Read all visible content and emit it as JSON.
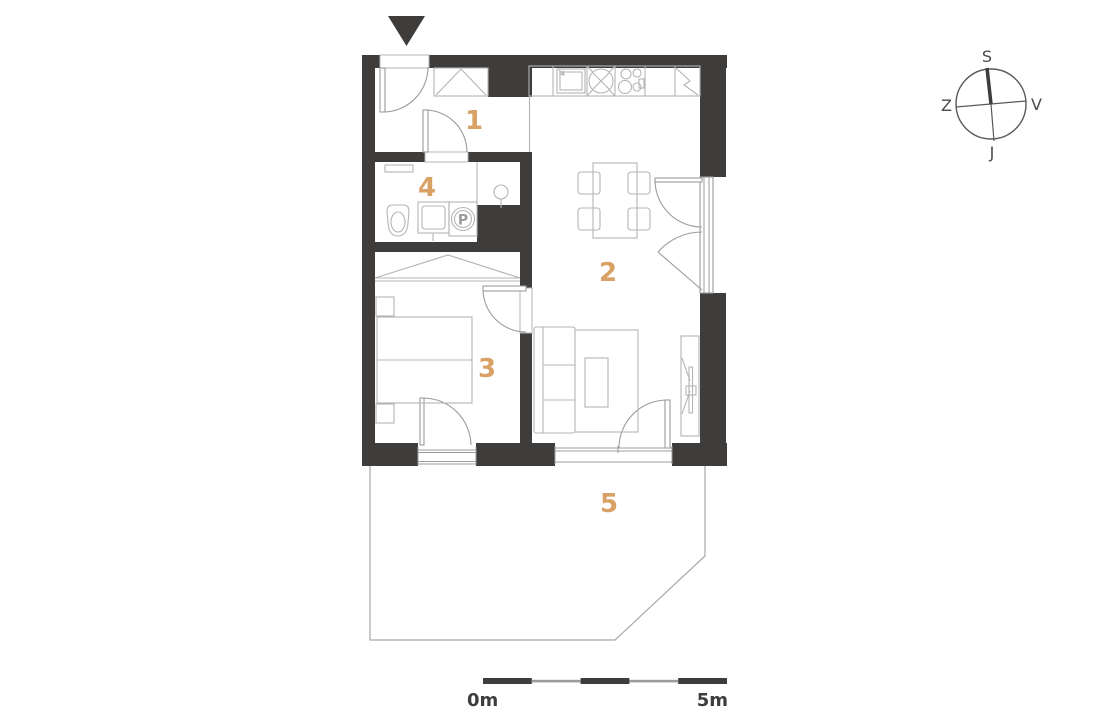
{
  "rooms": [
    {
      "label": "1"
    },
    {
      "label": "2"
    },
    {
      "label": "3"
    },
    {
      "label": "4"
    },
    {
      "label": "5"
    }
  ],
  "fixtures": {
    "washing_machine_label": "P"
  },
  "compass": {
    "top": "S",
    "right": "V",
    "bottom": "J",
    "left": "Z"
  },
  "scale_bar": {
    "start_label": "0m",
    "end_label": "5m"
  },
  "colors": {
    "wall": "#3e3d3b",
    "furniture_line": "#b4b4b3",
    "door_line": "#9c9c9b",
    "room_label_accent": "#d9a165",
    "compass_text": "#4a4a4b",
    "scale_text": "#3e3d3b"
  }
}
